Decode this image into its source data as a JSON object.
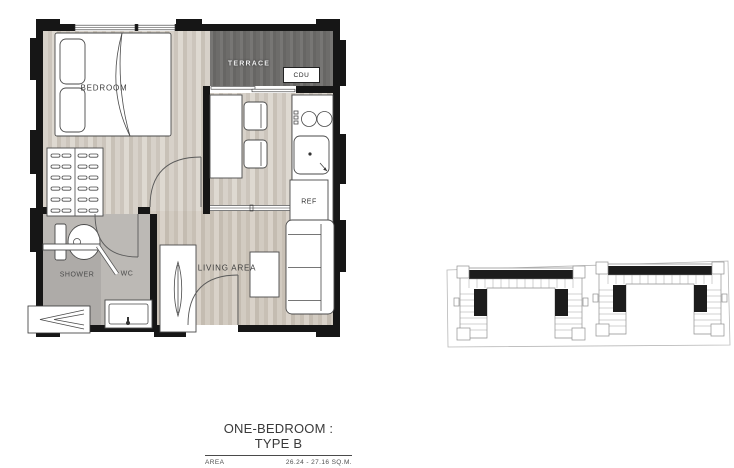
{
  "plan": {
    "labels": {
      "bedroom": "BEDROOM",
      "terrace": "TERRACE",
      "cdu": "CDU",
      "ref": "REF",
      "shower": "SHOWER",
      "wc": "WC",
      "living_area": "LIVING AREA"
    }
  },
  "title_block": {
    "title": "ONE-BEDROOM : TYPE B",
    "area_label": "AREA",
    "area_value": "26.24 - 27.16 SQ.M."
  },
  "colors": {
    "wall": "#161616",
    "terrace_floor": "#6d6c6a",
    "wood_floor": "#d7d1c9",
    "bath_floor": "#bcb9b5",
    "shower_floor": "#aeaba8",
    "furniture_outline": "#4a4a4a",
    "label_text": "#3d3d3d",
    "site_unit_dark": "#1c1c1c"
  }
}
